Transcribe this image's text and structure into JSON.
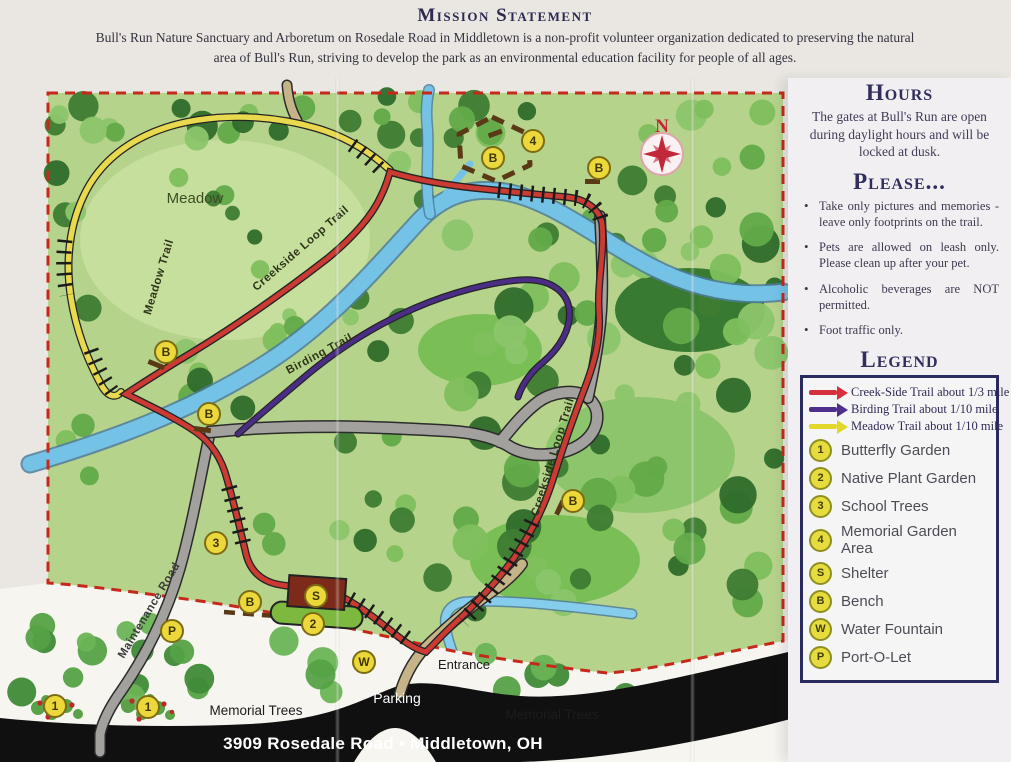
{
  "mission": {
    "title": "Mission Statement",
    "body": "Bull's Run Nature Sanctuary and Arboretum on Rosedale Road in Middletown is a non-profit volunteer organization dedicated to preserving the natural area of Bull's Run, striving to develop the park as an environmental education facility for people of all ages."
  },
  "sidebar": {
    "hours": {
      "title": "Hours",
      "text": "The gates at Bull's Run are open during daylight hours and will be locked at dusk."
    },
    "please": {
      "title": "Please...",
      "bullets": [
        "Take only pictures and memories - leave only footprints on the trail.",
        "Pets are allowed on leash only. Please clean up after your pet.",
        "Alcoholic beverages are NOT permitted.",
        "Foot traffic only."
      ]
    },
    "legend": {
      "title": "Legend",
      "trails": [
        {
          "name": "Creek-Side Trail about 1/3 mile",
          "color": "#d5303c"
        },
        {
          "name": "Birding Trail about 1/10 mile",
          "color": "#4f2f8e"
        },
        {
          "name": "Meadow Trail about 1/10 mile",
          "color": "#e2d82c"
        }
      ],
      "items": [
        {
          "sym": "1",
          "label": "Butterfly Garden"
        },
        {
          "sym": "2",
          "label": "Native Plant Garden"
        },
        {
          "sym": "3",
          "label": "School Trees"
        },
        {
          "sym": "4",
          "label": "Memorial Garden Area"
        },
        {
          "sym": "S",
          "label": "Shelter"
        },
        {
          "sym": "B",
          "label": "Bench"
        },
        {
          "sym": "W",
          "label": "Water Fountain"
        },
        {
          "sym": "P",
          "label": "Port-O-Let"
        }
      ]
    }
  },
  "map": {
    "labels": {
      "meadow": "Meadow",
      "meadow_trail": "Meadow Trail",
      "creekside_loop_trail": "Creekside Loop Trail",
      "birding_trail": "Birding Trail",
      "maintenance_road": "Maintenance Road",
      "entrance": "Entrance",
      "parking": "Parking",
      "memorial_trees": "Memorial Trees",
      "north": "N"
    },
    "address": "3909 Rosedale Road • Middletown, OH",
    "markers": [
      {
        "sym": "4"
      },
      {
        "sym": "B"
      },
      {
        "sym": "B"
      },
      {
        "sym": "B"
      },
      {
        "sym": "B"
      },
      {
        "sym": "B"
      },
      {
        "sym": "3"
      },
      {
        "sym": "B"
      },
      {
        "sym": "P"
      },
      {
        "sym": "S"
      },
      {
        "sym": "2"
      },
      {
        "sym": "W"
      },
      {
        "sym": "1"
      },
      {
        "sym": "1"
      }
    ],
    "colors": {
      "creekside_trail": "#cb3a33",
      "birding_trail": "#4b2d86",
      "meadow_trail": "#e8d94e",
      "creek": "#74c3e6",
      "park_green": "#b6d38b",
      "boundary_red": "#c6281c"
    }
  }
}
